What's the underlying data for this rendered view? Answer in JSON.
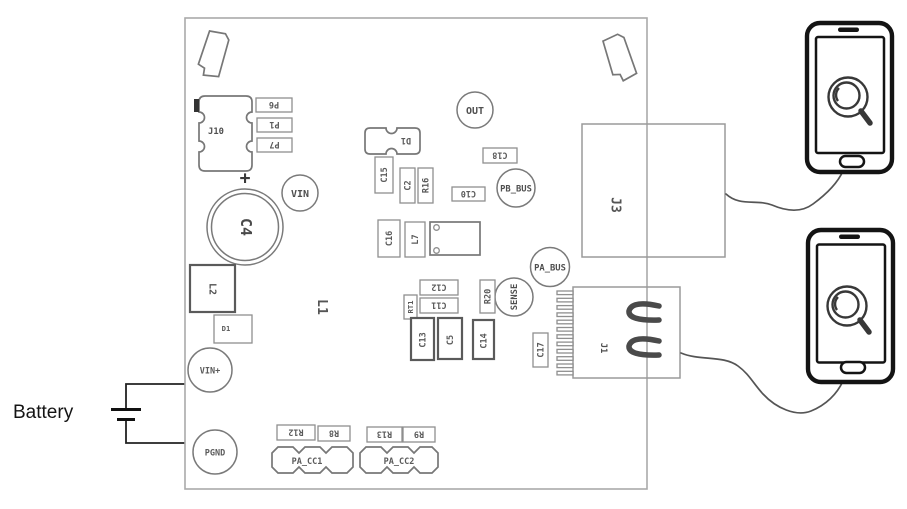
{
  "battery": {
    "label": "Battery"
  },
  "board": {
    "connectors": {
      "j10": "J10",
      "j3": "J3",
      "j1": "J1",
      "pa_cc1": "PA_CC1",
      "pa_cc2": "PA_CC2"
    },
    "test_points": {
      "vin": "VIN",
      "out": "OUT",
      "pb_bus": "PB_BUS",
      "pa_bus": "PA_BUS",
      "sense": "SENSE",
      "vin_plus": "VIN+",
      "pgnd": "PGND"
    },
    "components": {
      "p6": "P6",
      "p1": "P1",
      "p7": "P7",
      "plus": "+",
      "c4": "C4",
      "d1_top": "D1",
      "c15": "C15",
      "c2": "C2",
      "r16": "R16",
      "c18": "C18",
      "c10": "C10",
      "c16": "C16",
      "l7": "L7",
      "c12": "C12",
      "c11": "C11",
      "rt1": "RT1",
      "r20": "R20",
      "c13": "C13",
      "c5": "C5",
      "c14": "C14",
      "c17": "C17",
      "l1": "L1",
      "l2": "L2",
      "d1": "D1",
      "r12": "R12",
      "r8": "R8",
      "r13": "R13",
      "r9": "R9"
    }
  },
  "colors": {
    "board_outline": "#aaaaaa",
    "component_line": "#8f8f8f",
    "label_text": "#5a5a5a",
    "phone_line": "#141414",
    "background": "#ffffff"
  }
}
